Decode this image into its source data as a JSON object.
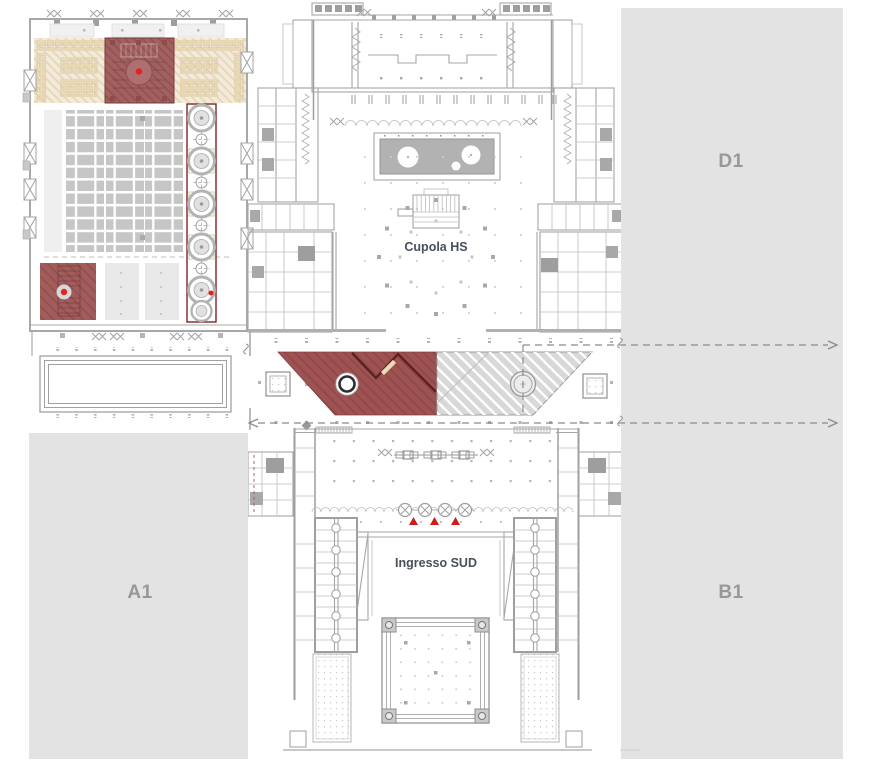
{
  "zones": {
    "d1": "D1",
    "a1": "A1",
    "b1": "B1"
  },
  "plan_labels": {
    "cupola": "Cupola HS",
    "ingresso_sud": "Ingresso SUD"
  },
  "markers": {
    "red_dots": 3,
    "red_triangles": 3
  },
  "colors": {
    "zone_fill": "#e3e3e3",
    "zone_label_text": "#97989b",
    "plan_line": "#a6a6a6",
    "highlight_red": "#9f5252",
    "highlight_red_dark": "#5c2121",
    "marker_red": "#e01f1f",
    "triangle_red": "#cd1d1d",
    "beige_fill": "#f3ead9",
    "hatched_zone_fill": "#d8d8d8",
    "label_text": "#47505d"
  }
}
